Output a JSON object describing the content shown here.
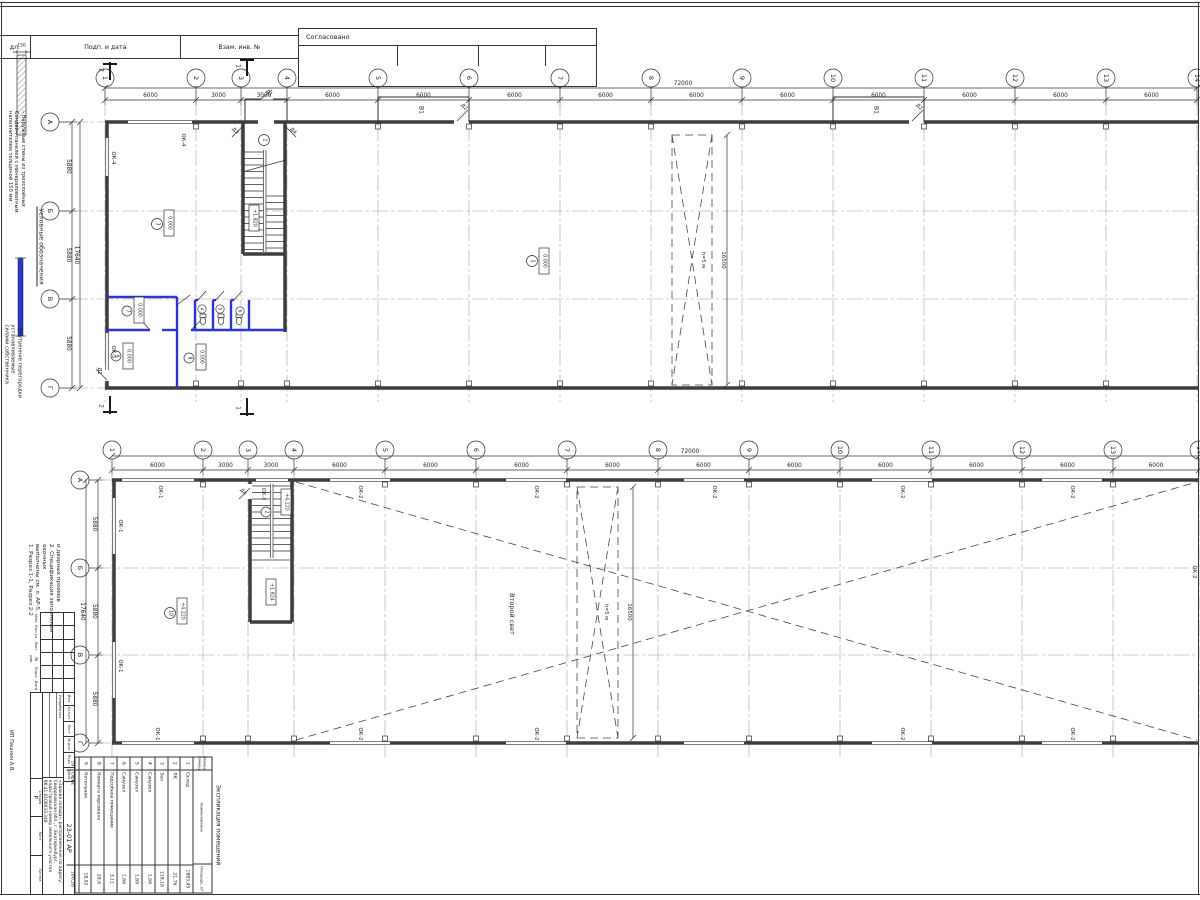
{
  "frame": {
    "col_podl": "дл.",
    "col_sign": "Подп. и дата",
    "col_inv": "Взам. инв. №",
    "approved": "Согласовано",
    "company_margin": "ИП Пашнин А.В."
  },
  "legend": {
    "title": "Условные обозначения",
    "wall_dim": "150",
    "item1_lines": [
      "- Наружные стены из трехслойных",
      "Сэндвич-панелей с минераловатным",
      "наполнителем толщиной 150 мм"
    ],
    "item2_lines": [
      "- Внутренние перегородки устанавливаемые",
      "силами собственника"
    ]
  },
  "notes_lines": [
    "1. Разрез 1-1, Разрез 2-2",
    "выполнены см. л. АР-5.",
    "2. Спецификация заполнения оконных",
    "и дверных проемов"
  ],
  "axes": {
    "cols": [
      "1",
      "2",
      "3",
      "4",
      "5",
      "6",
      "7",
      "8",
      "9",
      "10",
      "11",
      "12",
      "13",
      "14"
    ],
    "col_dims": [
      "6000",
      "3000",
      "3000",
      "6000",
      "6000",
      "6000",
      "6000",
      "6000",
      "6000",
      "6000",
      "6000",
      "6000",
      "6000"
    ],
    "total_width": "72000",
    "rows": [
      "А",
      "Б",
      "В",
      "Г"
    ],
    "row_dims": [
      "5880",
      "5880",
      "5880"
    ],
    "total_height": "17640",
    "brace_height": "16500"
  },
  "labels": {
    "ok1": "ОК-1",
    "ok2": "ОК-2",
    "ok3": "ОК-3",
    "ok4": "ОК-4",
    "ok5": "ОК-5",
    "v1": "В1",
    "d1": "Д1",
    "d2": "Д2",
    "d3": "Д3",
    "d4": "Д4",
    "level_zero": "0.000",
    "level_4220": "+4.220",
    "level_1820": "+1.820",
    "level_1824": "+1.824",
    "brace_note": "h=5 м",
    "second_light": "Второй свет",
    "sec_1": "1",
    "sec_2": "2"
  },
  "rooms1": [
    "1",
    "2",
    "3",
    "4",
    "5",
    "6",
    "7",
    "8",
    "9"
  ],
  "rooms2": [
    "2",
    "10"
  ],
  "room_schedule": {
    "title": "Экспликация помещений",
    "headers": [
      "Номер помещ.",
      "Наименование",
      "Площадь, м²"
    ],
    "rows": [
      [
        "1",
        "Склад",
        "1883,45"
      ],
      [
        "2",
        "ЛК",
        "21,76"
      ],
      [
        "3",
        "Зал",
        "118,16"
      ],
      [
        "4",
        "Санузел",
        "1,66"
      ],
      [
        "5",
        "Санузел",
        "1,69"
      ],
      [
        "6",
        "Санузел",
        "1,66"
      ],
      [
        "7",
        "Подсобное помещение",
        "3,11"
      ],
      [
        "8",
        "Комната персонала",
        "28,6"
      ],
      [
        "9",
        "Котельная",
        "18,92"
      ],
      [
        "10",
        "Офис",
        "160,26"
      ]
    ]
  },
  "title_block": {
    "doc_code": "23-01 АР",
    "project": "«Здание склада», расположенное по адресу: Свердловская обл., г. Екатеринбург, кадастровый номер земельного участка 66:41:0106033:346",
    "rev_headers": [
      "Изм.",
      "Кол.уч.",
      "Лист",
      "№ док.",
      "Подп.",
      "Дата"
    ],
    "developed_label": "Разработал",
    "stage_label": "Стадия",
    "sheet_label": "Лист",
    "sheets_label": "Листов",
    "stage": "Р"
  }
}
